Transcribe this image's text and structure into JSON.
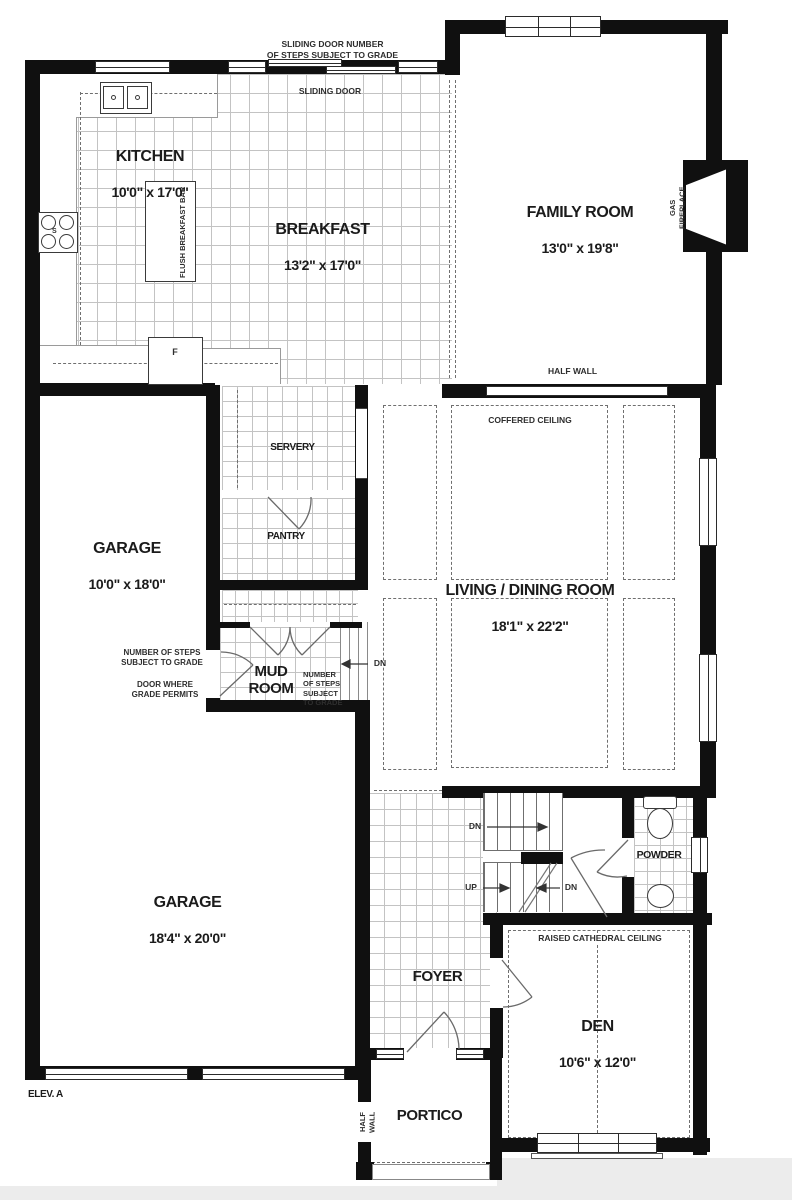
{
  "rooms": {
    "kitchen": {
      "name": "KITCHEN",
      "dims": "10'0\" x 17'0\""
    },
    "breakfast": {
      "name": "BREAKFAST",
      "dims": "13'2\" x 17'0\""
    },
    "family_room": {
      "name": "FAMILY ROOM",
      "dims": "13'0\" x 19'8\""
    },
    "garage_upper": {
      "name": "GARAGE",
      "dims": "10'0\" x 18'0\""
    },
    "garage_main": {
      "name": "GARAGE",
      "dims": "18'4\" x 20'0\""
    },
    "servery": {
      "name": "SERVERY"
    },
    "pantry": {
      "name": "PANTRY"
    },
    "mud_room": {
      "name": "MUD\nROOM"
    },
    "living_dining": {
      "name": "LIVING / DINING ROOM",
      "dims": "18'1\" x 22'2\""
    },
    "foyer": {
      "name": "FOYER"
    },
    "powder": {
      "name": "POWDER"
    },
    "den": {
      "name": "DEN",
      "dims": "10'6\" x 12'0\""
    },
    "portico": {
      "name": "PORTICO"
    }
  },
  "annotations": {
    "sliding_door_steps": "SLIDING DOOR NUMBER\nOF STEPS SUBJECT TO GRADE",
    "sliding_door": "SLIDING DOOR",
    "flush_breakfast_bar": "FLUSH BREAKFAST BAR",
    "gas_fireplace": "GAS FIREPLACE",
    "half_wall": "HALF WALL",
    "coffered_ceiling": "COFFERED CEILING",
    "steps_subject_left": "NUMBER OF STEPS\nSUBJECT TO GRADE",
    "door_where_grade": "DOOR WHERE\nGRADE PERMITS",
    "steps_subject_mud": "NUMBER\nOF STEPS\nSUBJECT\nTO GRADE",
    "raised_cathedral_ceiling": "RAISED CATHEDRAL CEILING",
    "half_wall_portico": "HALF WALL",
    "elevation": "ELEV. A",
    "dn": "DN",
    "up": "UP",
    "fridge": "F",
    "stove": "S"
  }
}
